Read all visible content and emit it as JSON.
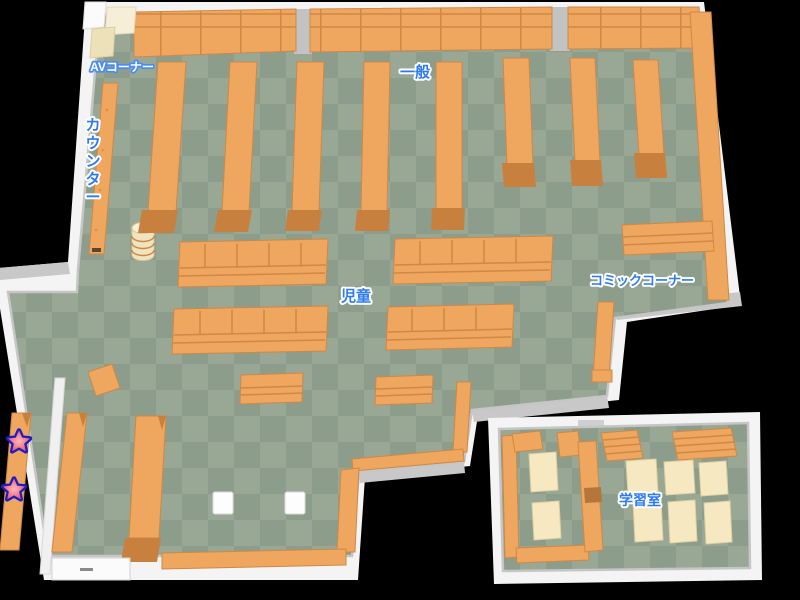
{
  "map": {
    "background": "#000000",
    "floor": {
      "light": "#99a795",
      "dark": "#8d9d8b"
    },
    "wall_color": "#f4f4f4",
    "shelf_colors": {
      "base": "#efa65e",
      "line": "#cf8845",
      "cap": "#c8803f"
    },
    "desk_color": "#f6e8c1",
    "label_style": {
      "fill": "#2e7bf0",
      "outline": "#ffffff"
    },
    "areas": {
      "av_corner": "AVコーナー",
      "counter": "カウンター",
      "general": "一般",
      "children": "児童",
      "comic_corner": "コミックコーナー",
      "study_room": "学習室"
    },
    "markers": {
      "star_count": 2,
      "star_fill": "#f2737f",
      "star_outline": "#1d1dc8"
    }
  }
}
